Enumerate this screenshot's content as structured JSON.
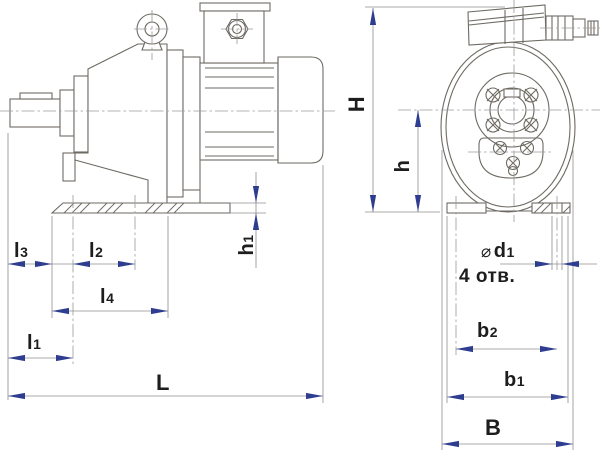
{
  "labels": {
    "H": {
      "base": "H",
      "sub": ""
    },
    "h": {
      "base": "h",
      "sub": ""
    },
    "h1": {
      "base": "h",
      "sub": "1"
    },
    "l3": {
      "base": "l",
      "sub": "3"
    },
    "l2": {
      "base": "l",
      "sub": "2"
    },
    "l4": {
      "base": "l",
      "sub": "4"
    },
    "l1": {
      "base": "l",
      "sub": "1"
    },
    "L": {
      "base": "L",
      "sub": ""
    },
    "d1": {
      "prefix": "⌀",
      "base": "d",
      "sub": "1"
    },
    "holes_note": "4 отв.",
    "b2": {
      "base": "b",
      "sub": "2"
    },
    "b1": {
      "base": "b",
      "sub": "1"
    },
    "B": {
      "base": "B",
      "sub": ""
    }
  },
  "colors": {
    "outline": "#6e6a63",
    "dimension": "#8f8f8f",
    "centerline": "#9a9a9a",
    "arrow": "#2e3d8f",
    "label": "#1d1d1d",
    "background": "#ffffff"
  }
}
